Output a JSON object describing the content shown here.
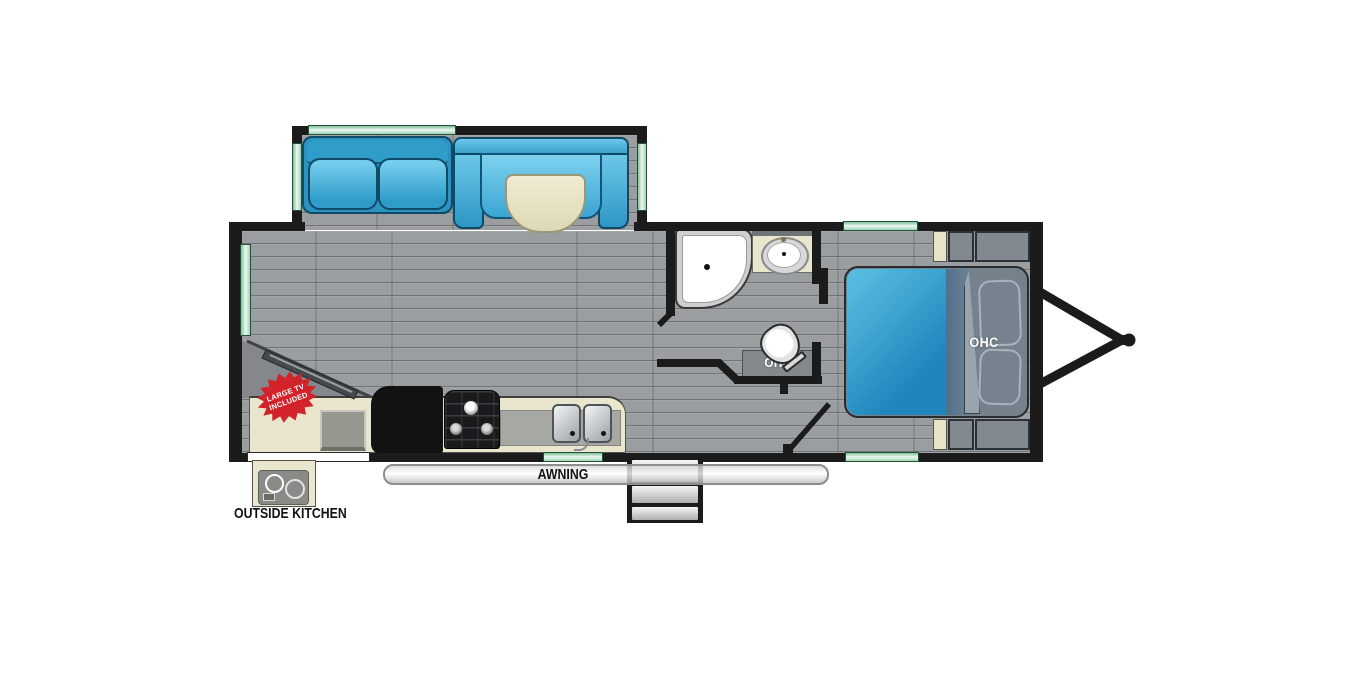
{
  "title": "Travel trailer floor plan",
  "labels": {
    "awning": "AWNING",
    "outside_kitchen": "OUTSIDE KITCHEN",
    "bath_ohc": "OHC",
    "bed_ohc": "OHC"
  },
  "badge": {
    "line1": "LARGE TV",
    "line2": "INCLUDED",
    "shape": "starburst"
  },
  "colors": {
    "wall_black": "#1b1b1b",
    "floor_gray": "#9b9ea1",
    "furniture_blue": "#2f9cc9",
    "bed_blue": "#2c93c4",
    "window_green": "#9ed4b4",
    "cabinet_cream": "#eae6ce",
    "cabinet_gray": "#828990",
    "badge_red": "#d2232a",
    "awning_white": "#f4f4f4"
  },
  "features": [
    "slide-out-sofa",
    "u-shaped-dinette",
    "booth-table",
    "corner-tv",
    "refrigerator",
    "range-cooktop",
    "double-kitchen-sink",
    "corner-shower",
    "bathroom-sink",
    "toilet",
    "overhead-cabinets",
    "bed",
    "wardrobes",
    "entry-door",
    "entry-steps",
    "awning",
    "outside-kitchen-cooktop",
    "a-frame-hitch",
    "windows"
  ]
}
